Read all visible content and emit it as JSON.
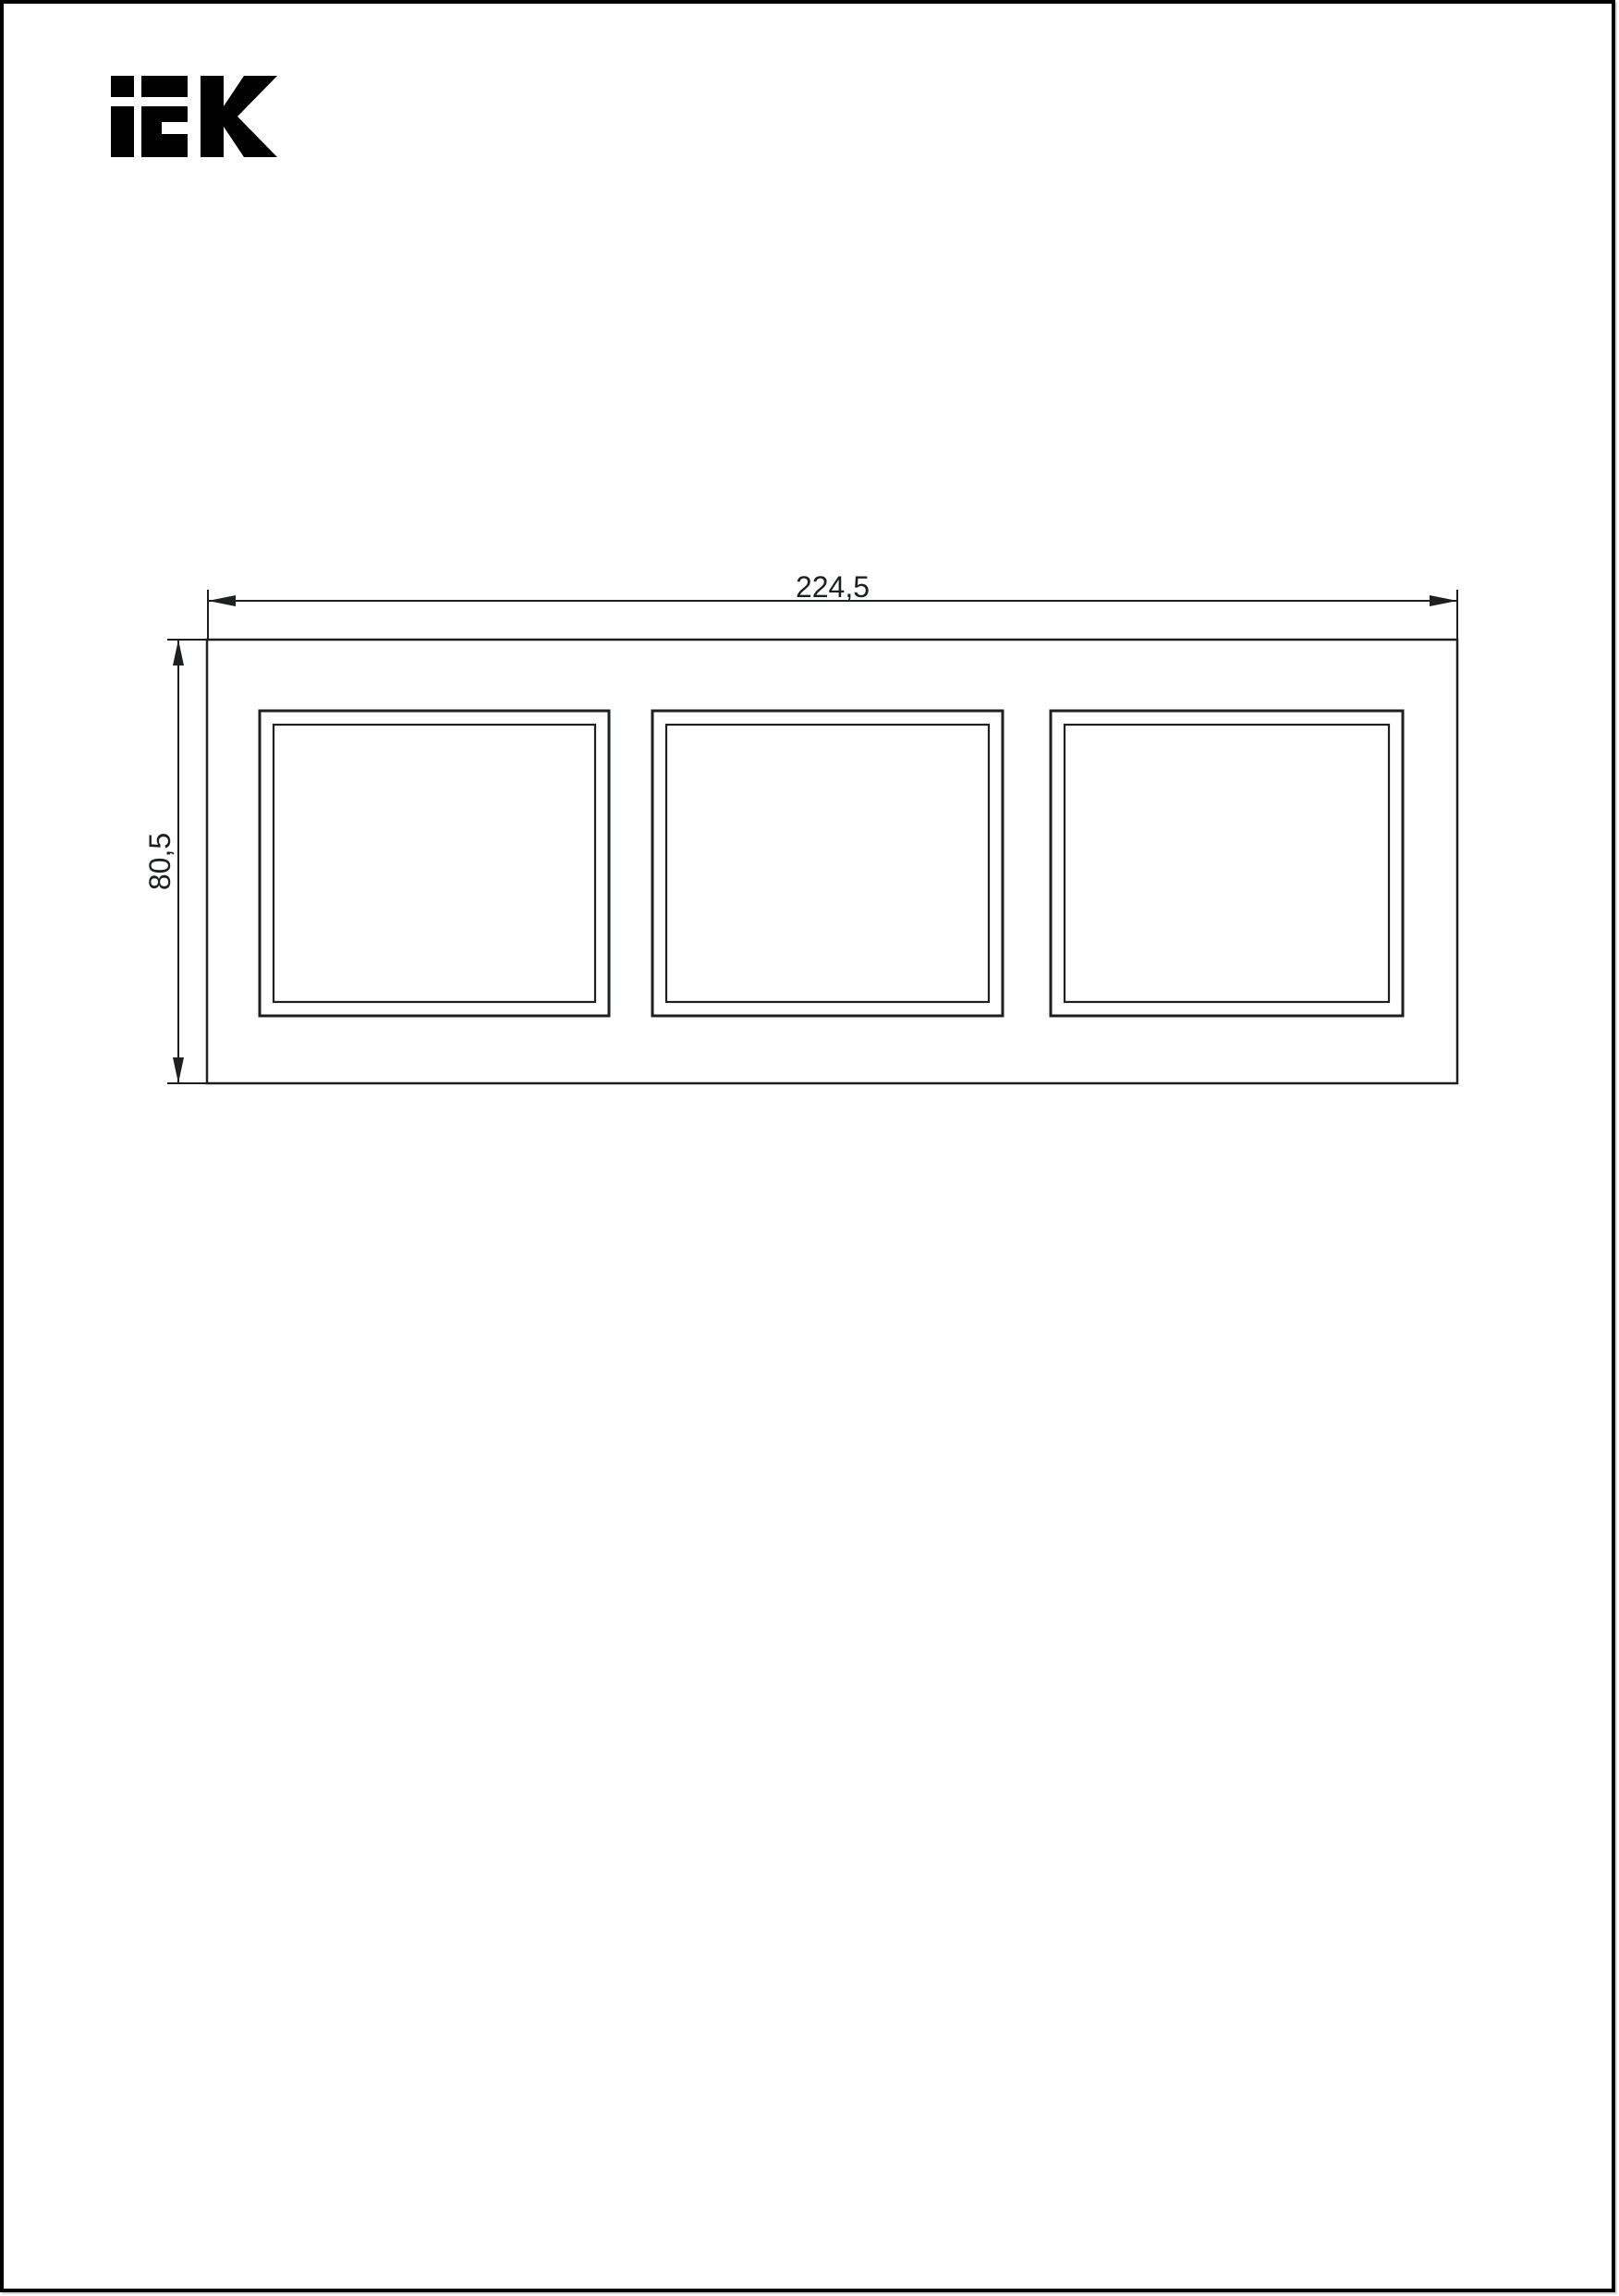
{
  "page": {
    "sheet_background": "#ffffff",
    "border_color": "#000000"
  },
  "logo": {
    "text": "IEK",
    "color": "#000000"
  },
  "drawing": {
    "line_color": "#1c2020",
    "window_count": 3,
    "dim_width": {
      "label": "224,5"
    },
    "dim_height": {
      "label": "80,5"
    }
  }
}
